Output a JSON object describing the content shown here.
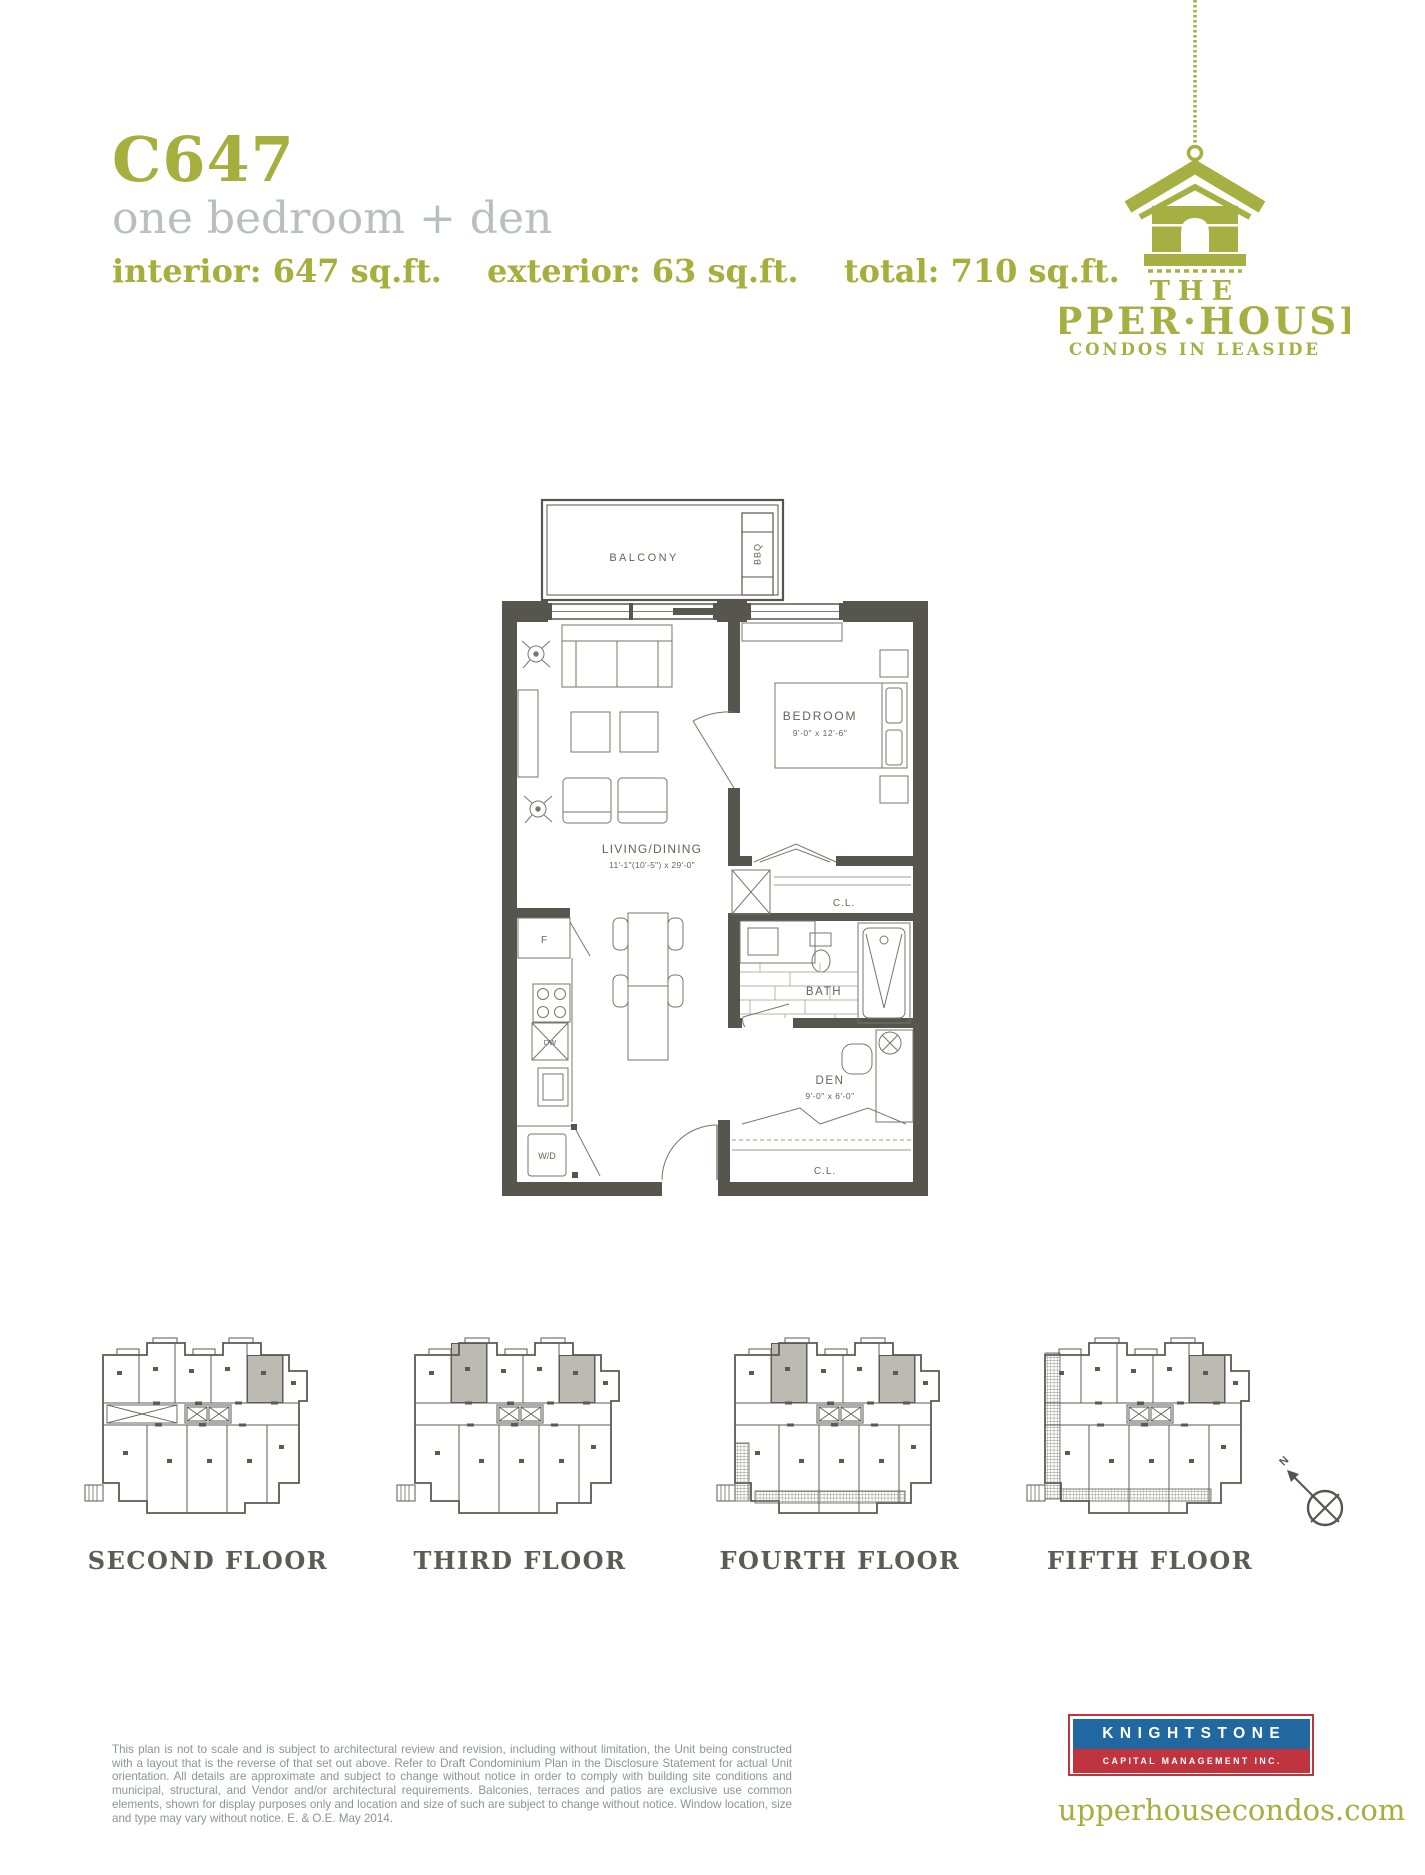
{
  "header": {
    "unit_code": "C647",
    "unit_type": "one bedroom + den",
    "stats": {
      "interior": "interior: 647 sq.ft.",
      "exterior": "exterior: 63 sq.ft.",
      "total": "total: 710 sq.ft."
    }
  },
  "brand": {
    "the": "THE",
    "name": "UPPER·HOUSE",
    "tagline": "CONDOS IN LEASIDE"
  },
  "plan": {
    "balcony": "BALCONY",
    "bbq": "BBQ",
    "bedroom": "BEDROOM",
    "bedroom_dim": "9'-0\" x 12'-6\"",
    "living": "LIVING/DINING",
    "living_dim": "11'-1\"(10'-5\") x 29'-0\"",
    "bath": "BATH",
    "den": "DEN",
    "den_dim": "9'-0\" x 6'-0\"",
    "closet_upper": "C.L.",
    "closet_lower": "C.L.",
    "fridge": "F",
    "dishwasher": "DW",
    "washer_dryer": "W/D"
  },
  "floors": [
    {
      "label": "SECOND FLOOR"
    },
    {
      "label": "THIRD FLOOR"
    },
    {
      "label": "FOURTH FLOOR"
    },
    {
      "label": "FIFTH FLOOR"
    }
  ],
  "compass": {
    "north": "N"
  },
  "disclaimer": "This plan is not to scale and is subject to architectural review and revision, including without limitation, the Unit being constructed with a layout that is the reverse of that set out above. Refer to Draft Condominium Plan in the Disclosure Statement for actual Unit orientation. All details are approximate and subject to change without notice in order to comply with building site conditions and municipal, structural, and Vendor and/or architectural requirements. Balconies, terraces and patios are exclusive use common elements, shown for display purposes only and location and size of such are subject to change without notice. Window location, size and type may vary without notice. E. & O.E. May 2014.",
  "footer": {
    "brand_top": "KNIGHTSTONE",
    "brand_bottom": "CAPITAL MANAGEMENT INC.",
    "website": "upperhousecondos.com"
  },
  "colors": {
    "olive": "#a6af3d",
    "wall": "#56554e",
    "highlight": "#bdbab4",
    "knightstone_blue": "#2168a0",
    "knightstone_red": "#c0343f"
  }
}
